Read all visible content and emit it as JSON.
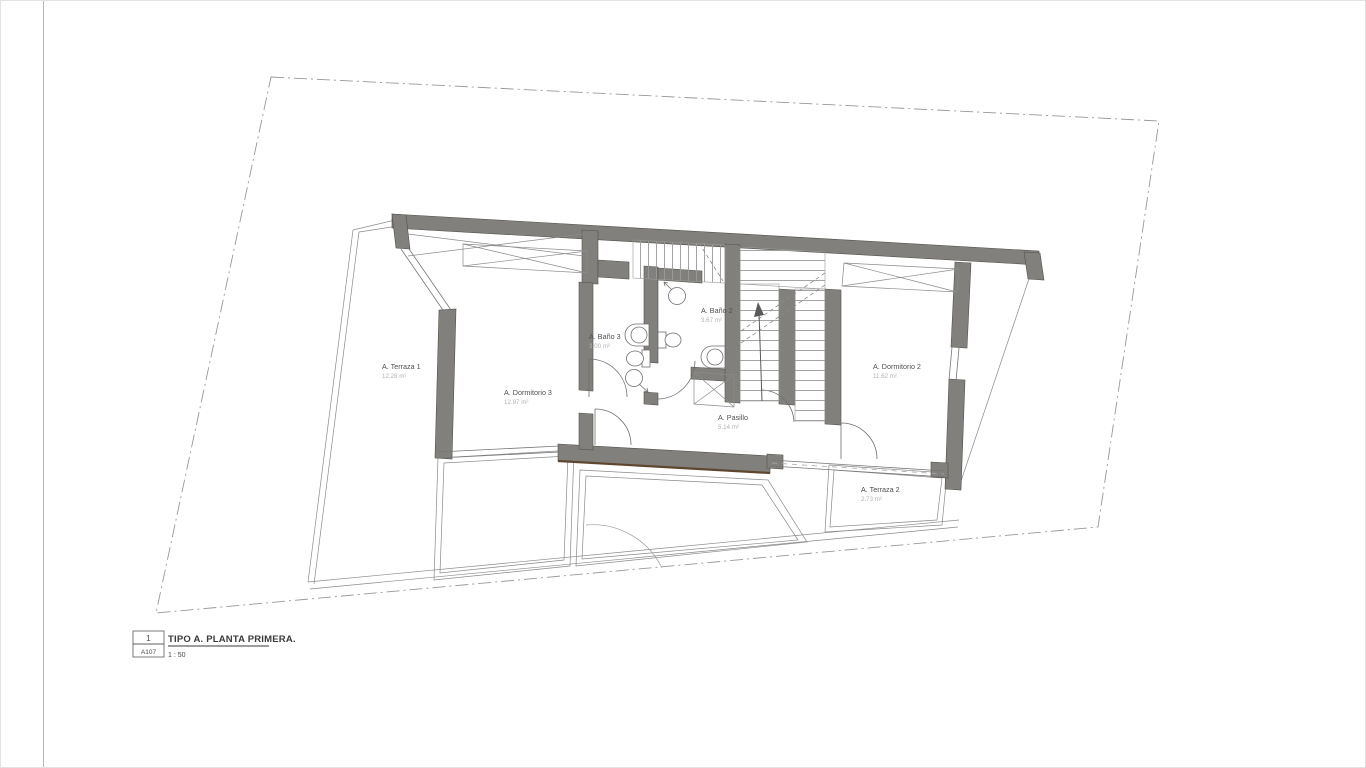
{
  "sheet": {
    "background": "#ffffff",
    "margin_line_color": "#b5b5b5"
  },
  "title_block": {
    "detail_number": "1",
    "sheet_ref": "A107",
    "title": "TIPO A. PLANTA PRIMERA.",
    "scale": "1 : 50"
  },
  "rooms": [
    {
      "name": "A. Terraza 1",
      "area": "12.28 m²"
    },
    {
      "name": "A. Dormitorio 3",
      "area": "12.97 m²"
    },
    {
      "name": "A. Baño 3",
      "area": "3.00 m²"
    },
    {
      "name": "A. Baño 2",
      "area": "3.67 m²"
    },
    {
      "name": "A. Pasillo",
      "area": "5.14 m²"
    },
    {
      "name": "A. Dormitorio 2",
      "area": "11.62 m²"
    },
    {
      "name": "A. Terraza 2",
      "area": "2.73 m²"
    }
  ],
  "colors": {
    "wall_fill": "#81807c",
    "wall_edge": "#55504a",
    "wood_accent": "#5e462f",
    "thin_line": "#6f6f6f",
    "light_line": "#9b9b9b",
    "boundary_dash": "#989898",
    "label_text": "#4f4f4f",
    "area_text": "#b2b2b2"
  }
}
